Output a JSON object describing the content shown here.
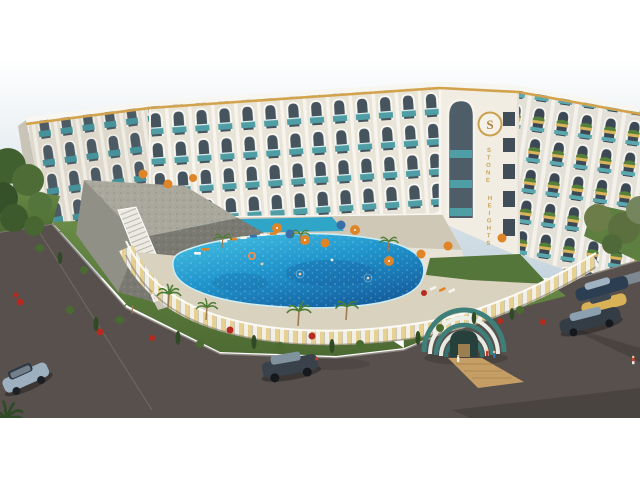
{
  "scene": {
    "type": "architectural-render",
    "description": "Aerial 3D rendering of a curved resort apartment complex with arched balconies, freeform swimming pool, landscaped gardens, arched entrance pavilion, roads and cars; white letterbox bars top and bottom",
    "signage": {
      "logo_letter": "S",
      "name_word_1": "STONE",
      "name_word_2": "HEIGHTS"
    },
    "palette": {
      "sky_top": "#ffffff",
      "sky_horizon": "#c6d5de",
      "facade": "#e9e4d8",
      "facade_shadow": "#ded9cc",
      "glass": "#46545e",
      "teal_accent": "#4f9da5",
      "gold_trim": "#d2a34c",
      "pool_water_light": "#49c4e4",
      "pool_water_deep": "#1b7fc4",
      "deck": "#d9d2bf",
      "panel_yellow": "#e6d193",
      "grass": "#5d7f3f",
      "road": "#57504d",
      "stone_wall": "#8f8e84",
      "wood_path": "#c59e66",
      "umbrella_orange": "#e08428",
      "umbrella_blue": "#3a6ea8",
      "flower_red": "#b62a20"
    },
    "objects": {
      "building": "curved mid-rise block, arched balcony frames, gold roof trim",
      "pool": "freeform blue pool with swimmers and float ring",
      "pavilion": "striped arched garden entrance tunnel",
      "staircase": "white outdoor stair on stone retaining wall",
      "cars_moving": 2,
      "cars_parked": 4,
      "letterbox_top_px": 58,
      "letterbox_bottom_px": 62
    }
  }
}
